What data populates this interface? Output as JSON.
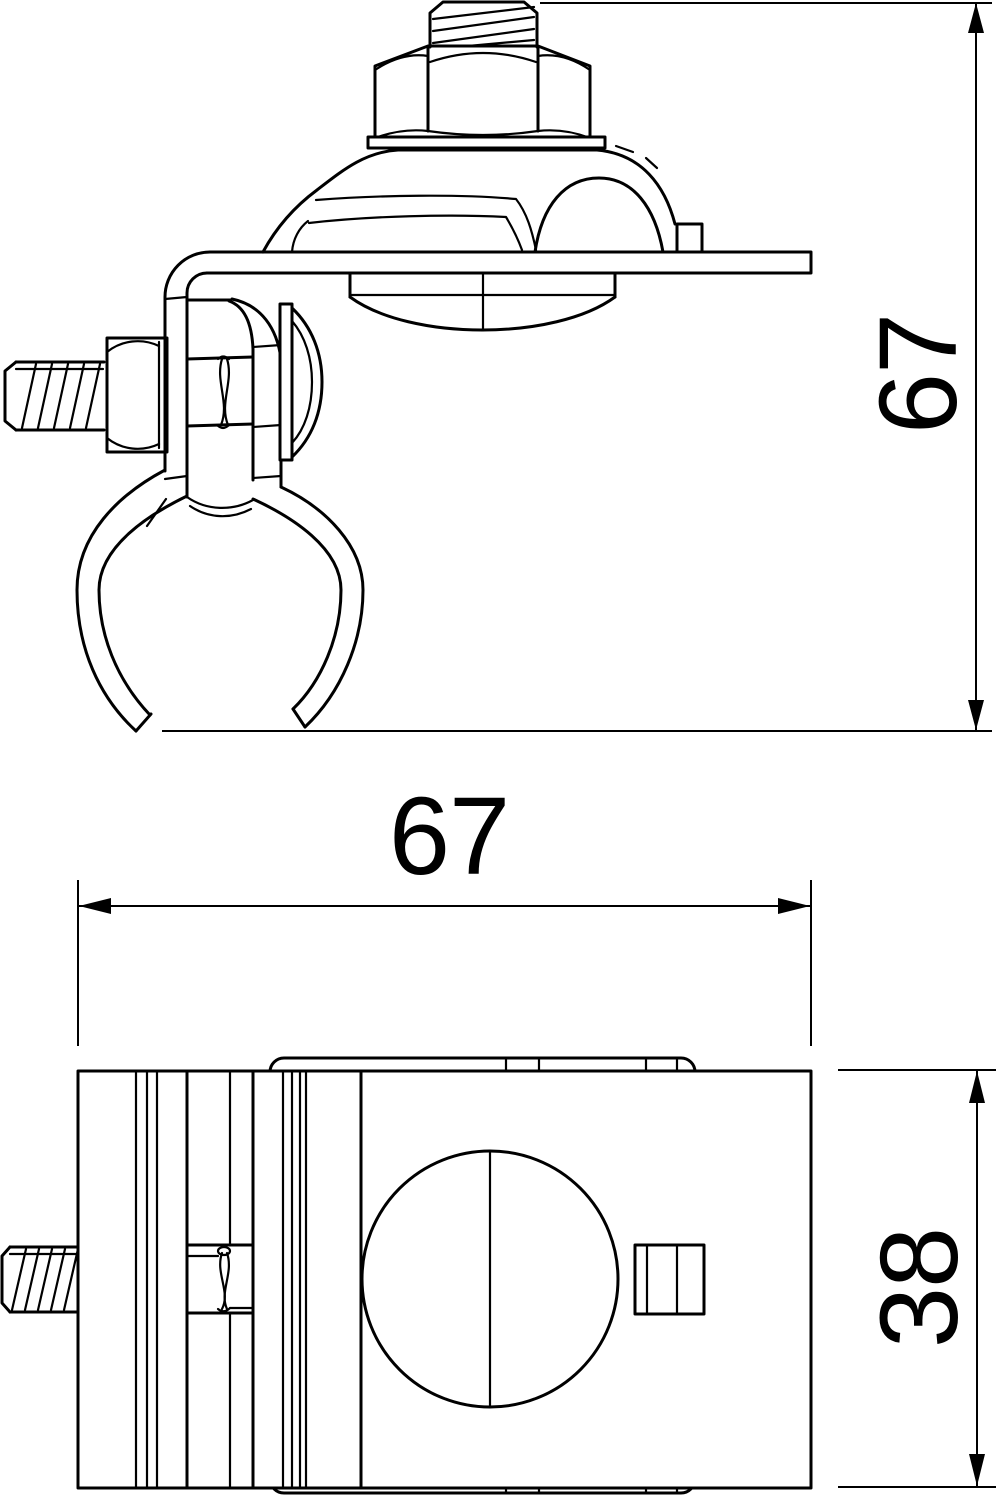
{
  "title": "Pipe clamp technical drawing, two orthographic views",
  "colors": {
    "background": "#ffffff",
    "line": "#000000"
  },
  "views": {
    "side": {
      "name": "side-view",
      "parts": [
        "threaded-stud",
        "hex-nut",
        "washer",
        "saddle-clamp",
        "mounting-plate",
        "carriage-bolt-head",
        "side-bolt",
        "clamp-screw",
        "front-strap",
        "dome-screw",
        "pipe-clamp-ring"
      ],
      "dimensions": {
        "height": {
          "label": "67",
          "orientation": "vertical"
        }
      }
    },
    "front": {
      "name": "front-view",
      "parts": [
        "back-plate",
        "clamp-body",
        "pipe-bore",
        "clamp-screw-slot",
        "screw-end",
        "side-bolt"
      ],
      "dimensions": {
        "width": {
          "label": "67",
          "orientation": "horizontal"
        },
        "height": {
          "label": "38",
          "orientation": "vertical"
        }
      }
    }
  }
}
